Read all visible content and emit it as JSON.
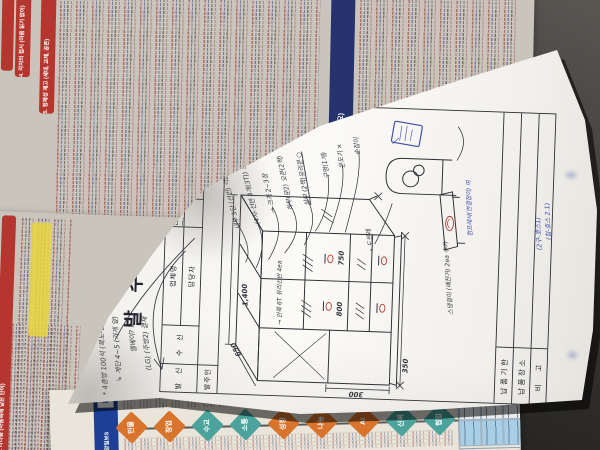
{
  "background": {
    "doc_top": {
      "header_4": "4. 각자의 접시 (마음 읽기 없이)",
      "header_5": "5. 정체성 제고 (세대, 교체, 공존)",
      "blue_band": "인상 용어법 (개요)",
      "accent_red": "#b5352f",
      "accent_blue": "#26336e"
    },
    "doc_left": {
      "header_2": "2. 나다움 (마음속에 담은 단어)"
    },
    "doc_bottom": {
      "banner": "중앙일보S",
      "diamonds": [
        {
          "label": "인물",
          "color": "#d9742c"
        },
        {
          "label": "창업",
          "color": "#d9742c"
        },
        {
          "label": "수교",
          "color": "#4ba39c"
        },
        {
          "label": "소통",
          "color": "#4ba39c"
        },
        {
          "label": "성장",
          "color": "#d9742c"
        },
        {
          "label": "나눔",
          "color": "#d9742c"
        },
        {
          "label": "AI",
          "color": "#d9742c"
        },
        {
          "label": "신뢰",
          "color": "#4ba39c"
        },
        {
          "label": "협업",
          "color": "#4ba39c"
        }
      ]
    }
  },
  "form": {
    "title": "발 주 의 뢰 서",
    "date_line": "20　　년　　월　　일",
    "header_table": {
      "sender": "발　신",
      "recipient": "수　신",
      "company": "업체명",
      "manager": "담당자",
      "sender_company": "심플라인(을지로)",
      "orderer": "발주인"
    },
    "footer_rows": {
      "r1": "납품기한",
      "r2": "납품장소",
      "r3": "비　고"
    },
    "scribbles": {
      "l1": "* 4층방 100석 (복도-끝방 → 2층)",
      "l2": "↳ 계단 4~5 (가게 앞)",
      "l3": "엘베이? 2",
      "l4": "(LG) (주방2) 결재"
    },
    "annotations": {
      "a1": "내부 3단 (선반) 각2중",
      "a2": "(4자-선반 4개(3T)) 보강",
      "a3": "→ 크기 2~3장",
      "a4": "하부(문2) 오픈(2짝)",
      "a5": "상부 (2짝)유리문 ○",
      "s1": "구멍(1개)",
      "s2": "온도기 ×",
      "s3": "손잡이",
      "interior": "→ 안쪽 6T 유리선반 4ea",
      "cart": "→ 도르레",
      "misc": "스댕걸이 (예전거) 2ea 추가"
    },
    "blue_notes": {
      "cart": "컴프레샤(연결잡이) 여",
      "corner1": "(2구-호스1)",
      "corner2": "(참-호스 2.1)"
    },
    "dimensions": {
      "width": "1,400",
      "depth": "650",
      "height": "300",
      "b1": "350",
      "b2": "800",
      "b3": "750"
    },
    "ink": {
      "pen": "#32323c",
      "red": "#b23a2e",
      "blue": "#3b4da8"
    }
  }
}
